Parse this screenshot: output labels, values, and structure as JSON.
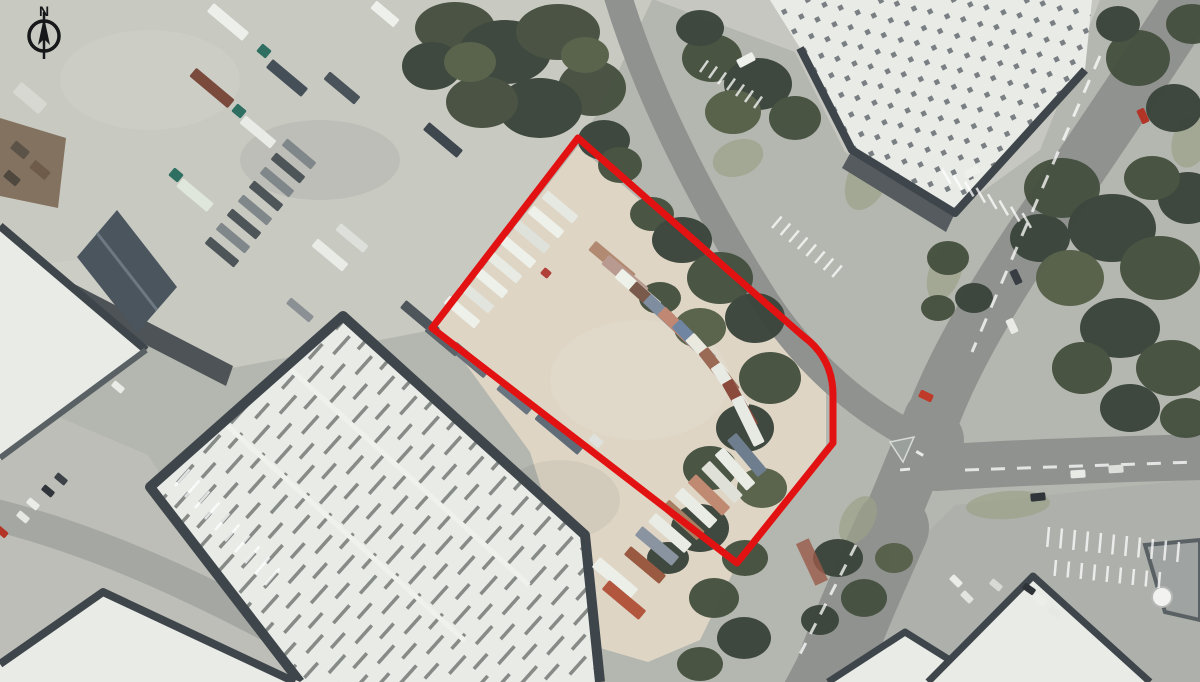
{
  "meta": {
    "description": "Aerial photograph of an industrial estate with a red site boundary outline around a container storage yard",
    "north_arrow": true
  },
  "compass": {
    "label": "N"
  },
  "palette": {
    "base": "#b4b7af",
    "yard": "#c8c9c1",
    "apron": "#c6c7c0",
    "lot": "#aeb1ab",
    "concrete": "#bcbeb7",
    "road": "#8f928f",
    "road-light": "#a5a8a2",
    "dirt": "#ded5c5",
    "tree": "#46503f",
    "tree-dark": "#3a443a",
    "tree-light": "#566049",
    "grass": "#9ba189",
    "roof-white": "#e9ebe7",
    "roof-frame": "#3f464b",
    "roof-shadow": "#555b5e",
    "roof-ridge": "#6d7370",
    "slate": "#4b555e",
    "rust": "#77634f",
    "shadow": "#4d5356",
    "boundary": "#e31212",
    "ink": "#16181a"
  },
  "boundary": {
    "path_d": "M 578,138 L 803,336 Q 833,358 833,395 L 833,443 L 737,563 L 432,328 Z",
    "color": "#e31212",
    "width": 7
  },
  "features": {
    "rects": [
      [
        462,
        312,
        40,
        40,
        10,
        "#eef0ea",
        "trailer"
      ],
      [
        476,
        297,
        40,
        40,
        10,
        "#e2e4de",
        "trailer"
      ],
      [
        490,
        282,
        40,
        40,
        10,
        "#eef0ea",
        "trailer"
      ],
      [
        504,
        267,
        40,
        40,
        10,
        "#e8eae4",
        "trailer"
      ],
      [
        518,
        252,
        40,
        40,
        10,
        "#eef0ea",
        "trailer"
      ],
      [
        532,
        237,
        40,
        40,
        10,
        "#dfe1db",
        "trailer"
      ],
      [
        546,
        222,
        40,
        40,
        10,
        "#eef0ea",
        "trailer"
      ],
      [
        560,
        207,
        40,
        40,
        10,
        "#e6e8e2",
        "trailer"
      ],
      [
        612,
        262,
        40,
        52,
        12,
        "#b28a72",
        "container"
      ],
      [
        625,
        276,
        40,
        52,
        12,
        "#b99a90",
        "container"
      ],
      [
        638,
        290,
        41,
        52,
        12,
        "#eef0ea",
        "container"
      ],
      [
        652,
        303,
        42,
        52,
        12,
        "#7a5a4a",
        "container"
      ],
      [
        666,
        316,
        43,
        52,
        12,
        "#7e8da0",
        "container"
      ],
      [
        680,
        329,
        44,
        52,
        12,
        "#c08873",
        "container"
      ],
      [
        694,
        342,
        46,
        52,
        12,
        "#6f85a2",
        "container"
      ],
      [
        707,
        356,
        48,
        52,
        12,
        "#e9e9df",
        "container"
      ],
      [
        719,
        371,
        52,
        52,
        12,
        "#9a6a55",
        "container"
      ],
      [
        730,
        387,
        56,
        52,
        12,
        "#e8eae4",
        "container"
      ],
      [
        740,
        404,
        60,
        52,
        12,
        "#8a4a3c",
        "container"
      ],
      [
        748,
        421,
        64,
        52,
        12,
        "#e7e9e3",
        "container"
      ],
      [
        747,
        455,
        50,
        48,
        12,
        "#6e7e8e",
        "container"
      ],
      [
        735,
        469,
        48,
        48,
        12,
        "#e9ebe5",
        "container"
      ],
      [
        722,
        482,
        46,
        48,
        12,
        "#dfe1d9",
        "container"
      ],
      [
        709,
        495,
        44,
        48,
        12,
        "#bf8a71",
        "container"
      ],
      [
        696,
        508,
        43,
        48,
        12,
        "#e9ebe5",
        "container"
      ],
      [
        683,
        520,
        42,
        48,
        12,
        "#a97f64",
        "container"
      ],
      [
        670,
        533,
        41,
        48,
        12,
        "#e9ebe5",
        "container"
      ],
      [
        657,
        546,
        40,
        48,
        12,
        "#8a93a0",
        "container"
      ],
      [
        645,
        565,
        40,
        46,
        11,
        "#9a5a42",
        "container"
      ],
      [
        615,
        578,
        40,
        50,
        13,
        "#eceee8",
        "container"
      ],
      [
        624,
        600,
        40,
        48,
        12,
        "#b2573e",
        "container"
      ],
      [
        560,
        432,
        40,
        56,
        13,
        "#5f6b77",
        "trailer"
      ],
      [
        596,
        441,
        40,
        13,
        9,
        "#dfe1dc",
        "truck-cab"
      ],
      [
        515,
        398,
        40,
        40,
        11,
        "#6a7480",
        "trailer"
      ],
      [
        470,
        360,
        40,
        44,
        11,
        "#676f79",
        "trailer"
      ],
      [
        420,
        318,
        40,
        44,
        10,
        "#4e565c",
        "trailer"
      ],
      [
        443,
        340,
        40,
        40,
        10,
        "#5a626a",
        "trailer"
      ],
      [
        546,
        273,
        40,
        9,
        8,
        "#b04038",
        "vehicle"
      ],
      [
        228,
        22,
        40,
        46,
        11,
        "#edefeb",
        "trailer"
      ],
      [
        212,
        88,
        40,
        50,
        11,
        "#7a4a3c",
        "trailer"
      ],
      [
        287,
        78,
        40,
        46,
        11,
        "#454f58",
        "trailer"
      ],
      [
        264,
        51,
        40,
        12,
        10,
        "#2e6f62",
        "truck-cab"
      ],
      [
        258,
        132,
        40,
        40,
        10,
        "#e9ebe7",
        "trailer"
      ],
      [
        239,
        111,
        40,
        12,
        10,
        "#2e6f62",
        "truck-cab"
      ],
      [
        342,
        88,
        40,
        40,
        10,
        "#4a525a",
        "trailer"
      ],
      [
        385,
        14,
        40,
        30,
        10,
        "#eef0ec",
        "trailer"
      ],
      [
        443,
        140,
        40,
        44,
        10,
        "#3f474e",
        "trailer"
      ],
      [
        195,
        195,
        40,
        40,
        11,
        "#dfe7dc",
        "trailer"
      ],
      [
        176,
        175,
        40,
        12,
        10,
        "#2e6f62",
        "truck-cab"
      ],
      [
        330,
        255,
        40,
        40,
        10,
        "#e9ebe7",
        "trailer"
      ],
      [
        352,
        238,
        40,
        36,
        9,
        "#dde0da",
        "trailer"
      ],
      [
        300,
        310,
        40,
        30,
        8,
        "#8a9094",
        "trailer"
      ],
      [
        222,
        252,
        40,
        38,
        9,
        "#4d5558",
        "trailer"
      ],
      [
        233,
        238,
        40,
        38,
        9,
        "#80878a",
        "trailer"
      ],
      [
        244,
        224,
        40,
        38,
        9,
        "#4d5558",
        "trailer"
      ],
      [
        255,
        210,
        40,
        38,
        9,
        "#80878a",
        "trailer"
      ],
      [
        266,
        196,
        40,
        38,
        9,
        "#4d5558",
        "trailer"
      ],
      [
        277,
        182,
        40,
        38,
        9,
        "#80878a",
        "trailer"
      ],
      [
        288,
        168,
        40,
        38,
        9,
        "#4d5558",
        "trailer"
      ],
      [
        299,
        154,
        40,
        38,
        9,
        "#80878a",
        "trailer"
      ],
      [
        30,
        98,
        40,
        34,
        14,
        "#d8d8d2",
        "shed"
      ],
      [
        20,
        150,
        40,
        18,
        10,
        "#5c5348",
        "shed"
      ],
      [
        40,
        170,
        40,
        20,
        10,
        "#6e5b4a",
        "shed"
      ],
      [
        12,
        178,
        40,
        16,
        9,
        "#4f483f",
        "shed"
      ],
      [
        1143,
        116,
        65,
        15,
        8,
        "#b23527",
        "car"
      ],
      [
        1016,
        277,
        65,
        15,
        8,
        "#383d43",
        "car"
      ],
      [
        1012,
        326,
        65,
        15,
        8,
        "#e9e9e6",
        "car"
      ],
      [
        1078,
        474,
        -4,
        15,
        8,
        "#e8eae6",
        "car"
      ],
      [
        1116,
        469,
        -4,
        15,
        8,
        "#dddfdb",
        "car"
      ],
      [
        1038,
        497,
        -6,
        15,
        8,
        "#30353a",
        "car"
      ],
      [
        926,
        396,
        25,
        14,
        8,
        "#bf3a28",
        "car"
      ],
      [
        746,
        60,
        -28,
        18,
        9,
        "#eef0ec",
        "van"
      ],
      [
        956,
        581,
        45,
        13,
        7,
        "#eaece8",
        "car"
      ],
      [
        967,
        597,
        45,
        13,
        7,
        "#e2e4e0",
        "car"
      ],
      [
        1029,
        589,
        35,
        13,
        7,
        "#2e3338",
        "car"
      ],
      [
        996,
        585,
        40,
        13,
        7,
        "#d8dad6",
        "car"
      ],
      [
        48,
        491,
        40,
        13,
        7,
        "#30353b",
        "car"
      ],
      [
        61,
        479,
        40,
        13,
        7,
        "#3c4248",
        "car"
      ],
      [
        33,
        504,
        40,
        13,
        7,
        "#eaece8",
        "car"
      ],
      [
        23,
        517,
        40,
        13,
        7,
        "#e5e7e3",
        "car"
      ],
      [
        2,
        532,
        40,
        12,
        7,
        "#b23527",
        "car"
      ],
      [
        118,
        387,
        40,
        13,
        7,
        "#eaece8",
        "car"
      ],
      [
        972,
        172,
        -28,
        15,
        8,
        "#eef0ec",
        "car"
      ],
      [
        1040,
        600,
        40,
        13,
        7,
        "#eceee9",
        "car"
      ],
      [
        1054,
        612,
        40,
        13,
        7,
        "#e6e8e3",
        "car"
      ]
    ],
    "stripe_groups": [
      [
        942,
        169,
        11.5,
        6.3,
        8,
        60,
        17
      ],
      [
        1049,
        527,
        13,
        1.5,
        11,
        95,
        20
      ],
      [
        1056,
        560,
        13,
        1.5,
        9,
        95,
        16
      ],
      [
        175,
        486,
        10,
        11,
        10,
        -49,
        22
      ],
      [
        772,
        228,
        8.6,
        7,
        8,
        -50,
        15
      ],
      [
        700,
        72,
        9,
        6,
        7,
        -55,
        14
      ]
    ]
  }
}
